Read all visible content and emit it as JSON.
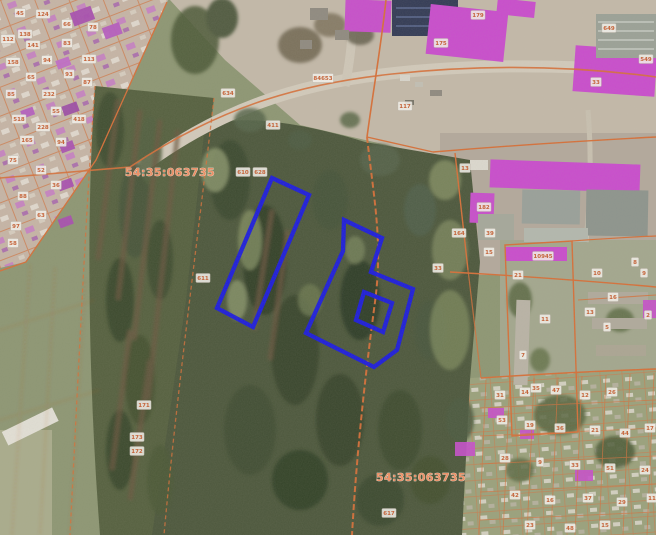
{
  "map": {
    "colors": {
      "selection_blue": "#1b1be0",
      "boundary_orange": "#d66f38",
      "building_magenta": "#c74fcb",
      "parcel_label_text": "#c65f33",
      "quarter_label_text": "#ee8e63"
    },
    "quarter_labels": [
      {
        "text": "54:35:063735",
        "x": 170,
        "y": 176
      },
      {
        "text": "54:35:063735",
        "x": 421,
        "y": 481
      }
    ],
    "selection": {
      "left_parcel_points": "272,178 309,195 253,327 217,308",
      "right_parcel_points": "344,220 382,238 371,272 413,289 397,350 374,367 306,333 343,251",
      "hole_points": "364,292 392,303 383,332 356,320"
    },
    "parcel_labels": [
      {
        "t": "45",
        "x": 20,
        "y": 13
      },
      {
        "t": "124",
        "x": 43,
        "y": 14
      },
      {
        "t": "66",
        "x": 67,
        "y": 24
      },
      {
        "t": "78",
        "x": 93,
        "y": 27
      },
      {
        "t": "138",
        "x": 25,
        "y": 34
      },
      {
        "t": "112",
        "x": 8,
        "y": 39
      },
      {
        "t": "141",
        "x": 33,
        "y": 45
      },
      {
        "t": "83",
        "x": 67,
        "y": 43
      },
      {
        "t": "158",
        "x": 13,
        "y": 62
      },
      {
        "t": "94",
        "x": 47,
        "y": 60
      },
      {
        "t": "113",
        "x": 89,
        "y": 59
      },
      {
        "t": "65",
        "x": 31,
        "y": 77
      },
      {
        "t": "93",
        "x": 69,
        "y": 74
      },
      {
        "t": "85",
        "x": 11,
        "y": 94
      },
      {
        "t": "232",
        "x": 49,
        "y": 94
      },
      {
        "t": "87",
        "x": 87,
        "y": 82
      },
      {
        "t": "55",
        "x": 56,
        "y": 111
      },
      {
        "t": "518",
        "x": 19,
        "y": 119
      },
      {
        "t": "228",
        "x": 43,
        "y": 127
      },
      {
        "t": "418",
        "x": 79,
        "y": 119
      },
      {
        "t": "165",
        "x": 27,
        "y": 140
      },
      {
        "t": "94",
        "x": 61,
        "y": 142
      },
      {
        "t": "75",
        "x": 13,
        "y": 160
      },
      {
        "t": "52",
        "x": 41,
        "y": 170
      },
      {
        "t": "36",
        "x": 56,
        "y": 185
      },
      {
        "t": "88",
        "x": 23,
        "y": 196
      },
      {
        "t": "63",
        "x": 41,
        "y": 215
      },
      {
        "t": "97",
        "x": 16,
        "y": 226
      },
      {
        "t": "58",
        "x": 13,
        "y": 243
      },
      {
        "t": "634",
        "x": 228,
        "y": 93
      },
      {
        "t": "411",
        "x": 273,
        "y": 125
      },
      {
        "t": "610",
        "x": 243,
        "y": 172
      },
      {
        "t": "628",
        "x": 260,
        "y": 172
      },
      {
        "t": "611",
        "x": 203,
        "y": 278
      },
      {
        "t": "171",
        "x": 144,
        "y": 405
      },
      {
        "t": "173",
        "x": 137,
        "y": 437
      },
      {
        "t": "172",
        "x": 137,
        "y": 451
      },
      {
        "t": "617",
        "x": 389,
        "y": 513
      },
      {
        "t": "33",
        "x": 438,
        "y": 268
      },
      {
        "t": "164",
        "x": 459,
        "y": 233
      },
      {
        "t": "84653",
        "x": 323,
        "y": 78
      },
      {
        "t": "117",
        "x": 405,
        "y": 106
      },
      {
        "t": "175",
        "x": 441,
        "y": 43
      },
      {
        "t": "179",
        "x": 478,
        "y": 15
      },
      {
        "t": "649",
        "x": 609,
        "y": 28
      },
      {
        "t": "33",
        "x": 596,
        "y": 82
      },
      {
        "t": "549",
        "x": 646,
        "y": 59
      },
      {
        "t": "13",
        "x": 465,
        "y": 168
      },
      {
        "t": "182",
        "x": 484,
        "y": 207
      },
      {
        "t": "39",
        "x": 490,
        "y": 233
      },
      {
        "t": "15",
        "x": 489,
        "y": 252
      },
      {
        "t": "10945",
        "x": 543,
        "y": 256
      },
      {
        "t": "21",
        "x": 518,
        "y": 275
      },
      {
        "t": "11",
        "x": 545,
        "y": 319
      },
      {
        "t": "10",
        "x": 597,
        "y": 273
      },
      {
        "t": "8",
        "x": 635,
        "y": 262
      },
      {
        "t": "9",
        "x": 644,
        "y": 273
      },
      {
        "t": "13",
        "x": 590,
        "y": 312
      },
      {
        "t": "5",
        "x": 607,
        "y": 327
      },
      {
        "t": "7",
        "x": 523,
        "y": 355
      },
      {
        "t": "35",
        "x": 536,
        "y": 388
      },
      {
        "t": "16",
        "x": 613,
        "y": 297
      },
      {
        "t": "2",
        "x": 648,
        "y": 315
      },
      {
        "t": "31",
        "x": 500,
        "y": 395
      },
      {
        "t": "14",
        "x": 525,
        "y": 392
      },
      {
        "t": "47",
        "x": 556,
        "y": 390
      },
      {
        "t": "12",
        "x": 585,
        "y": 395
      },
      {
        "t": "26",
        "x": 612,
        "y": 392
      },
      {
        "t": "53",
        "x": 502,
        "y": 420
      },
      {
        "t": "19",
        "x": 530,
        "y": 425
      },
      {
        "t": "36",
        "x": 560,
        "y": 428
      },
      {
        "t": "21",
        "x": 595,
        "y": 430
      },
      {
        "t": "44",
        "x": 625,
        "y": 433
      },
      {
        "t": "17",
        "x": 650,
        "y": 428
      },
      {
        "t": "28",
        "x": 505,
        "y": 458
      },
      {
        "t": "9",
        "x": 540,
        "y": 462
      },
      {
        "t": "33",
        "x": 575,
        "y": 465
      },
      {
        "t": "51",
        "x": 610,
        "y": 468
      },
      {
        "t": "24",
        "x": 645,
        "y": 470
      },
      {
        "t": "42",
        "x": 515,
        "y": 495
      },
      {
        "t": "16",
        "x": 550,
        "y": 500
      },
      {
        "t": "37",
        "x": 588,
        "y": 498
      },
      {
        "t": "29",
        "x": 622,
        "y": 502
      },
      {
        "t": "11",
        "x": 652,
        "y": 498
      },
      {
        "t": "23",
        "x": 530,
        "y": 525
      },
      {
        "t": "48",
        "x": 570,
        "y": 528
      },
      {
        "t": "15",
        "x": 605,
        "y": 525
      }
    ]
  }
}
